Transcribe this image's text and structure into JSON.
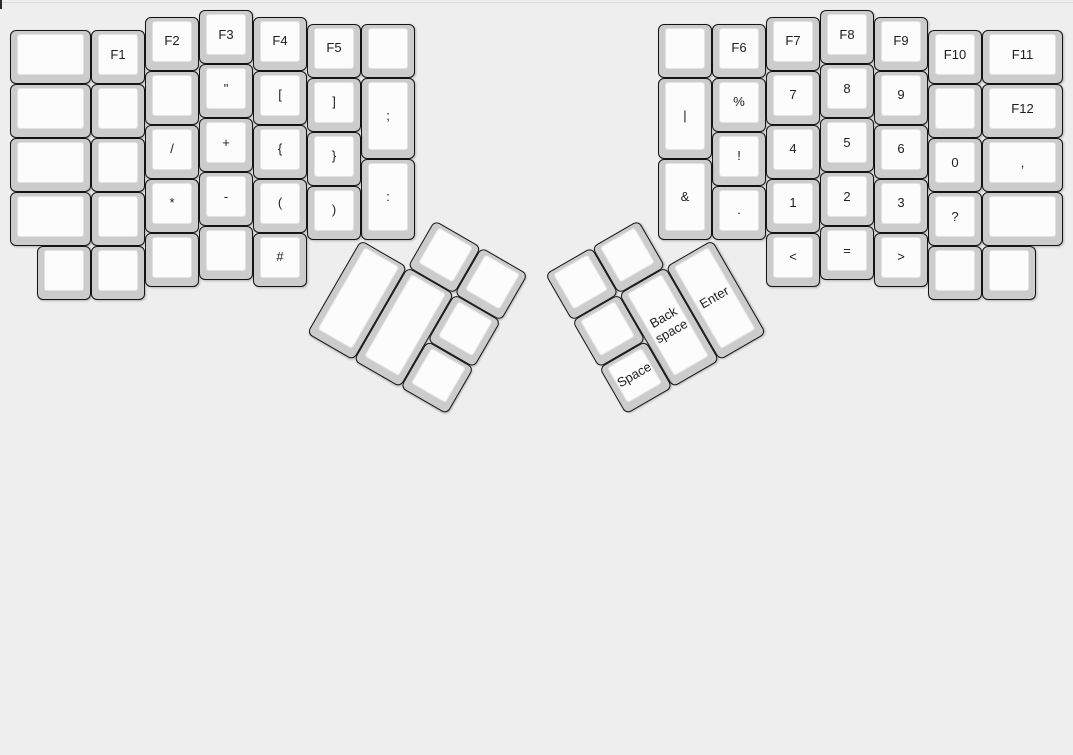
{
  "page": {
    "width": 1073,
    "height": 424,
    "background": "#eeeeee"
  },
  "artifacts": {
    "top_line_color": "#dcdcdc",
    "corner_notch_color": "#2a2a2a"
  },
  "keyboard": {
    "unit": 54,
    "origin": {
      "x": 10,
      "y": 10
    },
    "colors": {
      "base": "#cccccc",
      "cap": "#fcfcfc",
      "border": "#141414",
      "label": "#1d1d1d"
    },
    "groups": [
      {
        "name": "left-main",
        "r": 0,
        "keys": [
          {
            "x": 0,
            "y": 0.375,
            "w": 1.5,
            "label": "",
            "name": "key-blank"
          },
          {
            "x": 1.5,
            "y": 0.375,
            "label": "F1",
            "name": "key-f1"
          },
          {
            "x": 2.5,
            "y": 0.125,
            "label": "F2",
            "name": "key-f2"
          },
          {
            "x": 3.5,
            "y": 0,
            "label": "F3",
            "name": "key-f3"
          },
          {
            "x": 4.5,
            "y": 0.125,
            "label": "F4",
            "name": "key-f4"
          },
          {
            "x": 5.5,
            "y": 0.25,
            "label": "F5",
            "name": "key-f5"
          },
          {
            "x": 6.5,
            "y": 0.25,
            "label": "",
            "name": "key-blank"
          },
          {
            "x": 0,
            "y": 1.375,
            "w": 1.5,
            "label": "",
            "name": "key-blank"
          },
          {
            "x": 1.5,
            "y": 1.375,
            "label": "",
            "name": "key-blank"
          },
          {
            "x": 2.5,
            "y": 1.125,
            "label": "",
            "name": "key-blank"
          },
          {
            "x": 3.5,
            "y": 1,
            "label": "\"",
            "name": "key-double-quote"
          },
          {
            "x": 4.5,
            "y": 1.125,
            "label": "[",
            "name": "key-open-bracket"
          },
          {
            "x": 5.5,
            "y": 1.25,
            "label": "]",
            "name": "key-close-bracket"
          },
          {
            "x": 6.5,
            "y": 1.25,
            "h": 1.5,
            "label": ";",
            "name": "key-semicolon"
          },
          {
            "x": 0,
            "y": 2.375,
            "w": 1.5,
            "label": "",
            "name": "key-blank"
          },
          {
            "x": 1.5,
            "y": 2.375,
            "label": "",
            "name": "key-blank"
          },
          {
            "x": 2.5,
            "y": 2.125,
            "label": "/",
            "name": "key-slash"
          },
          {
            "x": 3.5,
            "y": 2,
            "label": "+",
            "name": "key-plus"
          },
          {
            "x": 4.5,
            "y": 2.125,
            "label": "{",
            "name": "key-open-brace"
          },
          {
            "x": 5.5,
            "y": 2.25,
            "label": "}",
            "name": "key-close-brace"
          },
          {
            "x": 6.5,
            "y": 2.75,
            "h": 1.5,
            "label": ":",
            "name": "key-colon"
          },
          {
            "x": 0,
            "y": 3.375,
            "w": 1.5,
            "label": "",
            "name": "key-blank"
          },
          {
            "x": 1.5,
            "y": 3.375,
            "label": "",
            "name": "key-blank"
          },
          {
            "x": 2.5,
            "y": 3.125,
            "label": "*",
            "name": "key-asterisk"
          },
          {
            "x": 3.5,
            "y": 3,
            "label": "-",
            "name": "key-minus"
          },
          {
            "x": 4.5,
            "y": 3.125,
            "label": "(",
            "name": "key-open-paren"
          },
          {
            "x": 5.5,
            "y": 3.25,
            "label": ")",
            "name": "key-close-paren"
          },
          {
            "x": 0.5,
            "y": 4.375,
            "label": "",
            "name": "key-blank"
          },
          {
            "x": 1.5,
            "y": 4.375,
            "label": "",
            "name": "key-blank"
          },
          {
            "x": 2.5,
            "y": 4.125,
            "label": "",
            "name": "key-blank"
          },
          {
            "x": 3.5,
            "y": 4,
            "label": "",
            "name": "key-blank"
          },
          {
            "x": 4.5,
            "y": 4.125,
            "label": "#",
            "name": "key-hash"
          }
        ]
      },
      {
        "name": "right-main",
        "r": 0,
        "keys": [
          {
            "x": 12,
            "y": 0.25,
            "label": "",
            "name": "key-blank"
          },
          {
            "x": 13,
            "y": 0.25,
            "label": "F6",
            "name": "key-f6"
          },
          {
            "x": 14,
            "y": 0.125,
            "label": "F7",
            "name": "key-f7"
          },
          {
            "x": 15,
            "y": 0,
            "label": "F8",
            "name": "key-f8"
          },
          {
            "x": 16,
            "y": 0.125,
            "label": "F9",
            "name": "key-f9"
          },
          {
            "x": 17,
            "y": 0.375,
            "label": "F10",
            "name": "key-f10"
          },
          {
            "x": 18,
            "y": 0.375,
            "w": 1.5,
            "label": "F11",
            "name": "key-f11"
          },
          {
            "x": 12,
            "y": 1.25,
            "h": 1.5,
            "label": "|",
            "name": "key-pipe"
          },
          {
            "x": 13,
            "y": 1.25,
            "label": "%",
            "name": "key-percent"
          },
          {
            "x": 14,
            "y": 1.125,
            "label": "7",
            "name": "key-7"
          },
          {
            "x": 15,
            "y": 1,
            "label": "8",
            "name": "key-8"
          },
          {
            "x": 16,
            "y": 1.125,
            "label": "9",
            "name": "key-9"
          },
          {
            "x": 17,
            "y": 1.375,
            "label": "",
            "name": "key-blank"
          },
          {
            "x": 18,
            "y": 1.375,
            "w": 1.5,
            "label": "F12",
            "name": "key-f12"
          },
          {
            "x": 13,
            "y": 2.25,
            "label": "!",
            "name": "key-exclamation"
          },
          {
            "x": 14,
            "y": 2.125,
            "label": "4",
            "name": "key-4"
          },
          {
            "x": 15,
            "y": 2,
            "label": "5",
            "name": "key-5"
          },
          {
            "x": 16,
            "y": 2.125,
            "label": "6",
            "name": "key-6"
          },
          {
            "x": 17,
            "y": 2.375,
            "label": "0",
            "name": "key-0"
          },
          {
            "x": 18,
            "y": 2.375,
            "w": 1.5,
            "label": ",",
            "name": "key-comma"
          },
          {
            "x": 12,
            "y": 2.75,
            "h": 1.5,
            "label": "&",
            "name": "key-ampersand"
          },
          {
            "x": 13,
            "y": 3.25,
            "label": ".",
            "name": "key-period"
          },
          {
            "x": 14,
            "y": 3.125,
            "label": "1",
            "name": "key-1"
          },
          {
            "x": 15,
            "y": 3,
            "label": "2",
            "name": "key-2"
          },
          {
            "x": 16,
            "y": 3.125,
            "label": "3",
            "name": "key-3"
          },
          {
            "x": 17,
            "y": 3.375,
            "label": "?",
            "name": "key-question"
          },
          {
            "x": 18,
            "y": 3.375,
            "w": 1.5,
            "label": "",
            "name": "key-blank"
          },
          {
            "x": 14,
            "y": 4.125,
            "label": "<",
            "name": "key-less-than"
          },
          {
            "x": 15,
            "y": 4,
            "label": "=",
            "name": "key-equals"
          },
          {
            "x": 16,
            "y": 4.125,
            "label": ">",
            "name": "key-greater-than"
          },
          {
            "x": 17,
            "y": 4.375,
            "label": "",
            "name": "key-blank"
          },
          {
            "x": 18,
            "y": 4.375,
            "label": "",
            "name": "key-blank"
          }
        ]
      },
      {
        "name": "left-thumb-cluster",
        "r": 30,
        "rx": 6.5,
        "ry": 4.25,
        "keys": [
          {
            "x": 7.5,
            "y": 3.25,
            "label": "",
            "name": "key-blank"
          },
          {
            "x": 8.5,
            "y": 3.25,
            "label": "",
            "name": "key-blank"
          },
          {
            "x": 6.5,
            "y": 4.25,
            "h": 2,
            "label": "",
            "name": "key-blank"
          },
          {
            "x": 7.5,
            "y": 4.25,
            "h": 2,
            "label": "",
            "name": "key-blank"
          },
          {
            "x": 8.5,
            "y": 4.25,
            "label": "",
            "name": "key-blank"
          },
          {
            "x": 8.5,
            "y": 5.25,
            "label": "",
            "name": "key-blank"
          }
        ]
      },
      {
        "name": "right-thumb-cluster",
        "r": -30,
        "rx": 13,
        "ry": 4.25,
        "keys": [
          {
            "x": 10,
            "y": 3.25,
            "label": "",
            "name": "key-blank"
          },
          {
            "x": 11,
            "y": 3.25,
            "label": "",
            "name": "key-blank"
          },
          {
            "x": 10,
            "y": 4.25,
            "label": "",
            "name": "key-blank"
          },
          {
            "x": 11,
            "y": 4.25,
            "h": 2,
            "label": "Back\nspace",
            "name": "key-backspace"
          },
          {
            "x": 12,
            "y": 4.25,
            "h": 2,
            "label": "Enter",
            "name": "key-enter"
          },
          {
            "x": 10,
            "y": 5.25,
            "label": "Space",
            "name": "key-space"
          }
        ]
      }
    ]
  }
}
